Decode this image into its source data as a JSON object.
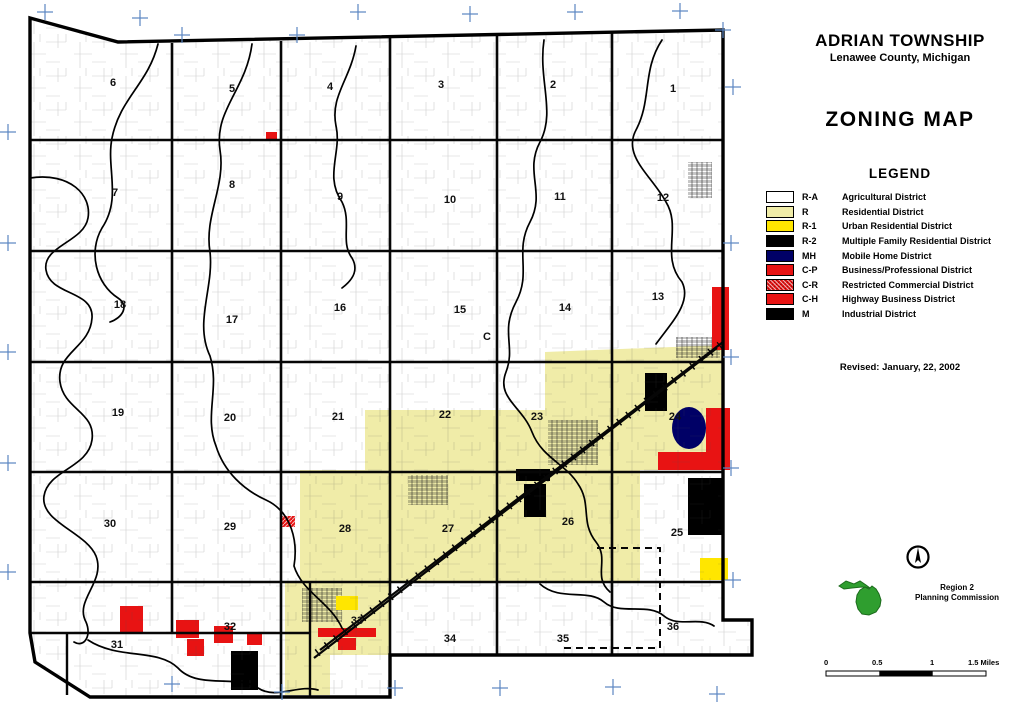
{
  "header": {
    "township": "ADRIAN TOWNSHIP",
    "county": "Lenawee County, Michigan",
    "map_type": "ZONING MAP"
  },
  "legend": {
    "title": "LEGEND",
    "entries": [
      {
        "code": "R-A",
        "label": "Agricultural District",
        "color": "#ffffff"
      },
      {
        "code": "R",
        "label": "Residential District",
        "color": "#f0eca8"
      },
      {
        "code": "R-1",
        "label": "Urban Residential District",
        "color": "#ffe600"
      },
      {
        "code": "R-2",
        "label": "Multiple Family Residential District",
        "color": "#000000"
      },
      {
        "code": "MH",
        "label": "Mobile Home District",
        "color": "#000066"
      },
      {
        "code": "C-P",
        "label": "Business/Professional District",
        "color": "#e81313"
      },
      {
        "code": "C-R",
        "label": "Restricted Commercial District",
        "color": "#e81313",
        "pattern": true
      },
      {
        "code": "C-H",
        "label": "Highway Business District",
        "color": "#e81313"
      },
      {
        "code": "M",
        "label": "Industrial District",
        "color": "#000000"
      }
    ]
  },
  "revised": "Revised: January, 22, 2002",
  "logo": {
    "line1": "Region 2",
    "line2": "Planning Commission",
    "color": "#2f9e2f"
  },
  "scale_bar": {
    "labels": [
      "0",
      "0.5",
      "1",
      "1.5 Miles"
    ]
  },
  "map": {
    "colors": {
      "R-A": "#ffffff",
      "R": "#f0eca8",
      "R-1": "#ffe600",
      "R-2": "#000000",
      "MH": "#000066",
      "C-P": "#e81313",
      "C-R": "#e81313",
      "C-H": "#e81313",
      "M": "#000000",
      "tick": "#5b86c2"
    },
    "sections": [
      {
        "n": "6",
        "x": 113,
        "y": 86
      },
      {
        "n": "5",
        "x": 232,
        "y": 92
      },
      {
        "n": "4",
        "x": 330,
        "y": 90
      },
      {
        "n": "3",
        "x": 441,
        "y": 88
      },
      {
        "n": "2",
        "x": 553,
        "y": 88
      },
      {
        "n": "1",
        "x": 673,
        "y": 92
      },
      {
        "n": "7",
        "x": 115,
        "y": 196
      },
      {
        "n": "8",
        "x": 232,
        "y": 188
      },
      {
        "n": "9",
        "x": 340,
        "y": 200
      },
      {
        "n": "10",
        "x": 450,
        "y": 203
      },
      {
        "n": "11",
        "x": 560,
        "y": 200
      },
      {
        "n": "12",
        "x": 663,
        "y": 201
      },
      {
        "n": "18",
        "x": 120,
        "y": 308
      },
      {
        "n": "17",
        "x": 232,
        "y": 323
      },
      {
        "n": "16",
        "x": 340,
        "y": 311
      },
      {
        "n": "15",
        "x": 460,
        "y": 313
      },
      {
        "n": "14",
        "x": 565,
        "y": 311
      },
      {
        "n": "13",
        "x": 658,
        "y": 300
      },
      {
        "n": "19",
        "x": 118,
        "y": 416
      },
      {
        "n": "20",
        "x": 230,
        "y": 421
      },
      {
        "n": "21",
        "x": 338,
        "y": 420
      },
      {
        "n": "22",
        "x": 445,
        "y": 418
      },
      {
        "n": "23",
        "x": 537,
        "y": 420
      },
      {
        "n": "24",
        "x": 675,
        "y": 420
      },
      {
        "n": "30",
        "x": 110,
        "y": 527
      },
      {
        "n": "29",
        "x": 230,
        "y": 530
      },
      {
        "n": "28",
        "x": 345,
        "y": 532
      },
      {
        "n": "27",
        "x": 448,
        "y": 532
      },
      {
        "n": "26",
        "x": 568,
        "y": 525
      },
      {
        "n": "25",
        "x": 677,
        "y": 536
      },
      {
        "n": "31",
        "x": 117,
        "y": 648
      },
      {
        "n": "32",
        "x": 230,
        "y": 630
      },
      {
        "n": "33",
        "x": 357,
        "y": 624
      },
      {
        "n": "34",
        "x": 450,
        "y": 642
      },
      {
        "n": "35",
        "x": 563,
        "y": 642
      },
      {
        "n": "36",
        "x": 673,
        "y": 630
      }
    ],
    "extra_labels": [
      {
        "t": "C",
        "x": 487,
        "y": 340
      }
    ],
    "zones": [
      {
        "shape": "poly",
        "code": "R",
        "points": "545,352 723,345 723,470 640,470 640,582 390,582 390,655 330,655 330,695 285,695 285,582 300,582 300,470 365,470 365,410 545,410"
      },
      {
        "shape": "rect",
        "code": "DENSE",
        "x": 688,
        "y": 162,
        "w": 24,
        "h": 36
      },
      {
        "shape": "rect",
        "code": "DENSE",
        "x": 676,
        "y": 337,
        "w": 44,
        "h": 21
      },
      {
        "shape": "rect",
        "code": "DENSE",
        "x": 548,
        "y": 420,
        "w": 50,
        "h": 45
      },
      {
        "shape": "rect",
        "code": "DENSE",
        "x": 302,
        "y": 588,
        "w": 40,
        "h": 34
      },
      {
        "shape": "rect",
        "code": "DENSE",
        "x": 408,
        "y": 475,
        "w": 40,
        "h": 30
      },
      {
        "shape": "rect",
        "code": "C-H",
        "x": 712,
        "y": 287,
        "w": 17,
        "h": 63
      },
      {
        "shape": "rect",
        "code": "C-P",
        "x": 266,
        "y": 132,
        "w": 11,
        "h": 9
      },
      {
        "shape": "rect",
        "code": "C-H",
        "x": 706,
        "y": 408,
        "w": 24,
        "h": 62
      },
      {
        "shape": "rect",
        "code": "C-H",
        "x": 658,
        "y": 452,
        "w": 48,
        "h": 18
      },
      {
        "shape": "ellipse",
        "code": "MH",
        "cx": 689,
        "cy": 428,
        "rx": 17,
        "ry": 21
      },
      {
        "shape": "rect",
        "code": "M",
        "x": 645,
        "y": 373,
        "w": 22,
        "h": 38
      },
      {
        "shape": "rect",
        "code": "M",
        "x": 688,
        "y": 478,
        "w": 35,
        "h": 57
      },
      {
        "shape": "rect",
        "code": "R-2",
        "x": 516,
        "y": 469,
        "w": 34,
        "h": 12
      },
      {
        "shape": "rect",
        "code": "R-2",
        "x": 524,
        "y": 484,
        "w": 22,
        "h": 33
      },
      {
        "shape": "rect",
        "code": "M",
        "x": 231,
        "y": 651,
        "w": 27,
        "h": 39
      },
      {
        "shape": "rect",
        "code": "R-1",
        "x": 700,
        "y": 558,
        "w": 28,
        "h": 22
      },
      {
        "shape": "rect",
        "code": "R-1",
        "x": 336,
        "y": 596,
        "w": 22,
        "h": 14
      },
      {
        "shape": "rect",
        "code": "C-P",
        "x": 120,
        "y": 606,
        "w": 23,
        "h": 26
      },
      {
        "shape": "rect",
        "code": "C-P",
        "x": 176,
        "y": 620,
        "w": 23,
        "h": 18
      },
      {
        "shape": "rect",
        "code": "C-P",
        "x": 187,
        "y": 639,
        "w": 17,
        "h": 17
      },
      {
        "shape": "rect",
        "code": "C-P",
        "x": 214,
        "y": 626,
        "w": 19,
        "h": 17
      },
      {
        "shape": "rect",
        "code": "C-P",
        "x": 247,
        "y": 632,
        "w": 15,
        "h": 13
      },
      {
        "shape": "rect",
        "code": "C-R",
        "x": 282,
        "y": 516,
        "w": 13,
        "h": 11
      },
      {
        "shape": "rect",
        "code": "C-H",
        "x": 318,
        "y": 628,
        "w": 58,
        "h": 9
      },
      {
        "shape": "rect",
        "code": "C-H",
        "x": 338,
        "y": 638,
        "w": 18,
        "h": 12
      }
    ],
    "ticks": [
      [
        45,
        12
      ],
      [
        140,
        18
      ],
      [
        358,
        12
      ],
      [
        470,
        14
      ],
      [
        575,
        12
      ],
      [
        680,
        11
      ],
      [
        182,
        35
      ],
      [
        297,
        35
      ],
      [
        8,
        132
      ],
      [
        8,
        243
      ],
      [
        8,
        352
      ],
      [
        8,
        463
      ],
      [
        8,
        572
      ],
      [
        172,
        684
      ],
      [
        282,
        692
      ],
      [
        395,
        688
      ],
      [
        500,
        688
      ],
      [
        613,
        687
      ],
      [
        717,
        694
      ],
      [
        733,
        87
      ],
      [
        731,
        243
      ],
      [
        731,
        357
      ],
      [
        731,
        468
      ],
      [
        733,
        580
      ],
      [
        723,
        30
      ]
    ]
  }
}
